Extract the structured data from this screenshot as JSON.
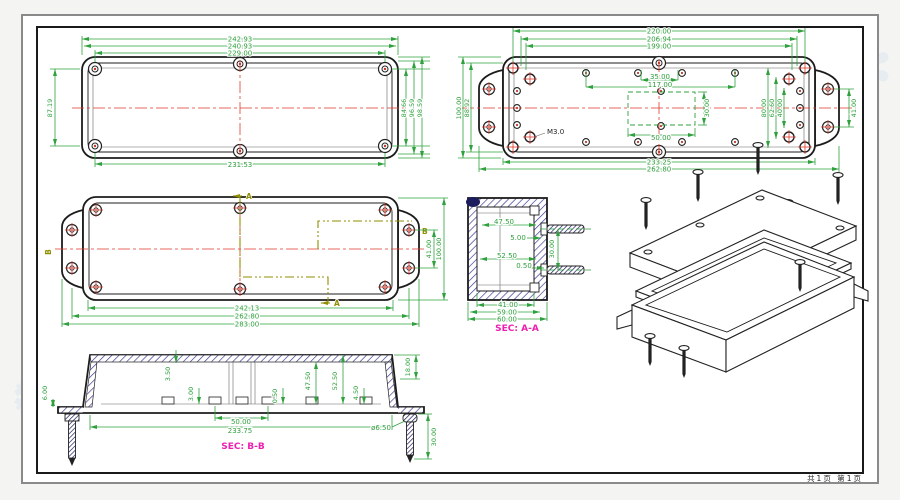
{
  "sheet": {
    "page_label": "共1页 第1页"
  },
  "colors": {
    "dim": "#2ea03c",
    "centerline": "#e03a2e",
    "section_line": "#8f8f00",
    "sec_label": "#ee1fb0",
    "hatch": "#30308f"
  },
  "v1": {
    "top": [
      "242.93",
      "240.93",
      "229.00"
    ],
    "bottom": "231.53",
    "left": "87.19",
    "right": [
      "84.66",
      "96.59",
      "98.59"
    ]
  },
  "v2": {
    "top": [
      "220.00",
      "206.94",
      "199.00"
    ],
    "row": [
      "35.00",
      "117.00"
    ],
    "rect_w": "50.00",
    "rect_h": "30.00",
    "left": [
      "100.00",
      "88.92"
    ],
    "right": [
      "80.00",
      "62.60",
      "40.00"
    ],
    "flange": "41.00",
    "bottom": [
      "233.25",
      "262.80"
    ],
    "thread": "M3.0"
  },
  "v3": {
    "bottom": [
      "242.13",
      "262.80",
      "283.00"
    ],
    "right": [
      "41.00",
      "100.00"
    ],
    "a": "A",
    "b": "B"
  },
  "v4": {
    "label": "SEC: A-A",
    "d": [
      "47.50",
      "5.00",
      "52.50",
      "0.50"
    ],
    "right": "30.00",
    "bottom": [
      "41.00",
      "59.00",
      "60.00"
    ]
  },
  "v5": {
    "label": "SEC: B-B",
    "top": [
      "3.50",
      "3.00",
      "0.50",
      "47.50",
      "52.50",
      "4.50"
    ],
    "left": "6.00",
    "right": "18.00",
    "bottom": [
      "50.00",
      "233.75",
      "ø6.50",
      "30.00"
    ]
  }
}
